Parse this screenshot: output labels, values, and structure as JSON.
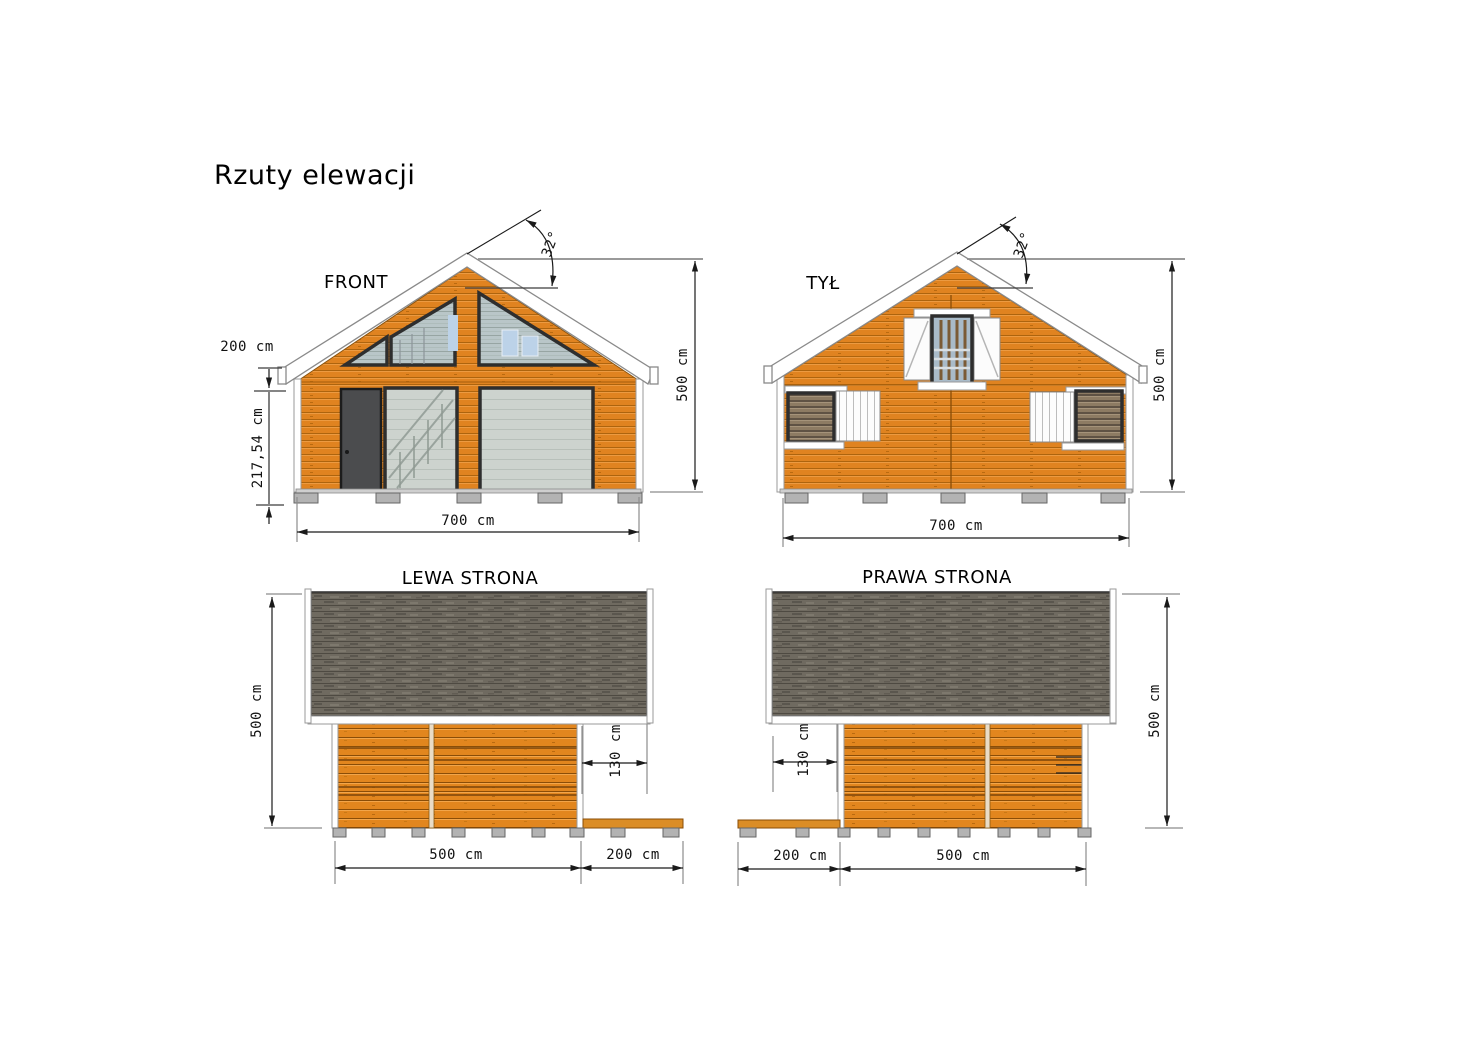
{
  "title": "Rzuty elewacji",
  "colors": {
    "wood": "#E08320",
    "roof_shingles": "#6F6A60",
    "fascia": "#FFFFFF",
    "door": "#4B4C4E",
    "glass": "#CDD3CE",
    "foundation_block": "#B3B3B3",
    "dimension_line": "#1A1A1A",
    "extension_line": "#8C8C8C"
  },
  "views": {
    "front": {
      "label": "FRONT",
      "dimensions": {
        "roof_angle": "32°",
        "eave_offset": "200 cm",
        "wall_height": "217,54 cm",
        "width": "700 cm",
        "total_height": "500 cm"
      }
    },
    "back": {
      "label": "TYŁ",
      "dimensions": {
        "roof_angle": "32°",
        "width": "700 cm",
        "total_height": "500 cm"
      }
    },
    "left_side": {
      "label": "LEWA STRONA",
      "dimensions": {
        "total_height": "500 cm",
        "roof_overhang": "130 cm",
        "body_length": "500 cm",
        "terrace_length": "200 cm"
      }
    },
    "right_side": {
      "label": "PRAWA STRONA",
      "dimensions": {
        "total_height": "500 cm",
        "roof_overhang": "130 cm",
        "terrace_length": "200 cm",
        "body_length": "500 cm"
      }
    }
  }
}
